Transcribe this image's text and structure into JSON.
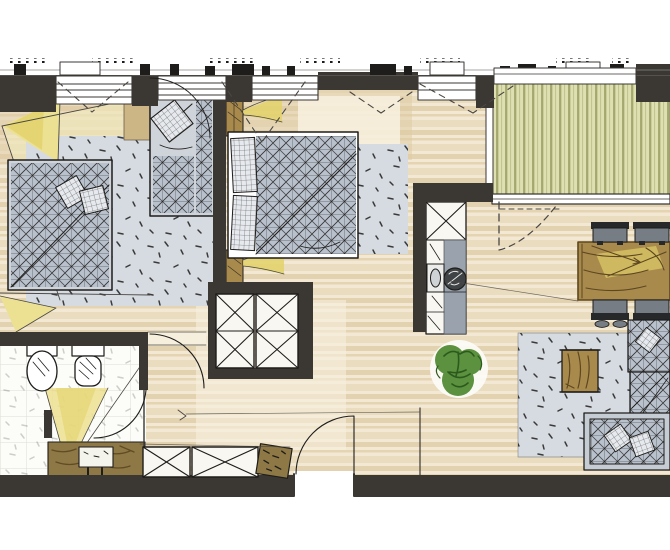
{
  "image": {
    "kind": "hand-drawn architectural floor plan sketch (marker rendering)",
    "description": "Apartment floor plan sketch: two bedrooms on the left, bathroom lower-left, hall closets in the center, kitchen block and living-dining area on the right, striped balcony deck top-right. No text labels are visible.",
    "width": 670,
    "height": 550
  },
  "palette": {
    "paper": "#ffffff",
    "ink": "#1e1d1b",
    "wall": "#3b3834",
    "wallSoft": "#55524d",
    "floorBase": "#f2e8d3",
    "floorBand": "#ddc9a1",
    "floorBand2": "#e9dbbc",
    "floorDeep": "#d9c296",
    "rugBase": "#d6dbe2",
    "deckBase": "#dfe0b2",
    "deckStripe": "#a4a76e",
    "bedGray": "#b9c1cd",
    "bedFrame": "#cfd4da",
    "pillowGray": "#e6e9ed",
    "yellowPale": "#f2ecc0",
    "yellowLight": "#ece192",
    "yellowCore": "#e3d26a",
    "woodBrown": "#a98a4d",
    "woodDark": "#5d4721",
    "tanBlock": "#cdb685",
    "vanityBrown": "#8d7846",
    "plantGreen": "#5c9140",
    "plantDark": "#2c5a1d",
    "counterGray": "#9aa3ad",
    "applianceDark": "#3f4346",
    "chairGray": "#767d85",
    "chairDark": "#26282a",
    "tileLine": "#deded6",
    "cabinetWhite": "#f9f7f2",
    "guide": "#4a4743"
  },
  "rooms": [
    {
      "name": "bedroom-left",
      "items": [
        "double-bed",
        "single-bed",
        "area-rug",
        "tan-headboard-block",
        "yellow-light-beam"
      ]
    },
    {
      "name": "bedroom-middle",
      "items": [
        "double-bed",
        "two-nightstands",
        "two-wall-lamp-beams",
        "area-rug"
      ]
    },
    {
      "name": "hall",
      "items": [
        "two-x-wardrobes-center",
        "two-x-wardrobes-bottom",
        "shoe-bench",
        "entry-door"
      ]
    },
    {
      "name": "bathroom",
      "items": [
        "toilet",
        "wall-hung-toilet",
        "vanity-with-sink",
        "yellow-light-beam",
        "door"
      ]
    },
    {
      "name": "kitchen",
      "items": [
        "tall-cabinet",
        "counter-run",
        "sink",
        "cooktop",
        "plant"
      ]
    },
    {
      "name": "living-dining",
      "items": [
        "dining-table",
        "four-chairs",
        "area-rug",
        "coffee-table",
        "corner-sofa",
        "chaise"
      ]
    },
    {
      "name": "balcony",
      "items": [
        "striped-decking",
        "sliding-door"
      ]
    }
  ]
}
